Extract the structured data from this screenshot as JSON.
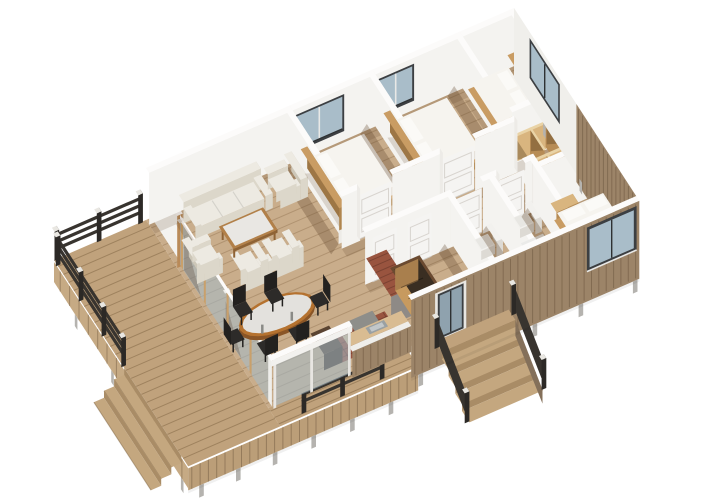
{
  "meta": {
    "title": "3D floor plan rendering",
    "description": "Axonometric 3D floor plan of a single-storey house with wrap-around wooden deck, entry porch and flat-cut white walls",
    "background": "#ffffff"
  },
  "scene": {
    "style": "3d-cutaway-floorplan",
    "rooms": [
      {
        "name": "deck-terrace",
        "floor": "wood planks",
        "features": [
          "dark wood railing",
          "corner steps",
          "side steps",
          "support feet"
        ]
      },
      {
        "name": "living-room",
        "furniture": [
          "three-seat-sofa",
          "armchair",
          "armchair",
          "lounge-chair",
          "lounge-chair",
          "coffee-table-marble-top"
        ]
      },
      {
        "name": "dining-area",
        "furniture": [
          "oval-marble-table-wood-rim",
          "six-black-chairs"
        ],
        "features": [
          "full-height glass wall to deck",
          "glass sliding doors"
        ]
      },
      {
        "name": "kitchen",
        "furniture": [
          "tiled-floor",
          "island-stove",
          "serving-counter-with-sink",
          "dark-cabinet"
        ]
      },
      {
        "name": "entry",
        "features": [
          "glazed-front-door",
          "stair-opening-plywood-lined",
          "masonry-hearth",
          "porch-with-steps-and-railing"
        ]
      },
      {
        "name": "hallway",
        "features": [
          "white-paneled-doors"
        ]
      },
      {
        "name": "bedroom-1",
        "furniture": [
          "double-bed-wood-headboard"
        ],
        "features": [
          "back-wall-window"
        ]
      },
      {
        "name": "bedroom-2",
        "furniture": [
          "double-bed-wood-headboard"
        ],
        "features": [
          "back-wall-window"
        ]
      },
      {
        "name": "bedroom-3",
        "furniture": [
          "double-bed-wood-headboard"
        ],
        "features": [
          "end-wall-window"
        ]
      },
      {
        "name": "walk-in-closet",
        "furniture": [
          "plywood-wardrobe-unit",
          "plywood-wardrobe-unit"
        ]
      },
      {
        "name": "bathroom-1",
        "furniture": [
          "vanity-sink",
          "toilet"
        ]
      },
      {
        "name": "bathroom-2",
        "furniture": [
          "vanity-sink",
          "toilet"
        ]
      },
      {
        "name": "master-bedroom",
        "furniture": [
          "double-bed",
          "wood-bench"
        ],
        "features": [
          "front-wall-window"
        ]
      }
    ]
  },
  "palette": {
    "bg": "#ffffff",
    "floorWood": "#c9ad8b",
    "floorLine": "rgba(136,106,72,0.38)",
    "deckWood": "#c0a27c",
    "deckLine": "rgba(118,90,58,0.45)",
    "deckFascia": "#bb9e78",
    "deckFasciaSide": "#c6aa84",
    "wallFace": "#f4f3f0",
    "wallCap": "#fcfbfa",
    "wallEnd": "#edebe7",
    "wallShadow": "rgba(92,66,40,0.30)",
    "softShadow": "rgba(92,66,40,0.18)",
    "glass": "rgba(164,188,202,0.55)",
    "glassSolid": "#a9bdc9",
    "glassDark": "#8fa2ae",
    "frameDark": "#3c3f42",
    "postWood": "#c9a06b",
    "postCap": "#efeeea",
    "cornerWood": "#b98a58",
    "railDark": "#38342f",
    "railPost": "#2c2926",
    "railCap": "#e9e7e2",
    "siding": "#9c8468",
    "sidingLine": "rgba(92,70,48,0.40)",
    "sidingDark": "#84705a",
    "feet": "#b5b3af",
    "sofaTop": "#edeae2",
    "sofaFront": "#dcd7ca",
    "sofaSide": "#cdc7b8",
    "woodFurn": "#b28049",
    "woodFurnDark": "#8f6335",
    "marbleTop": "#e9e7e3",
    "tableTop": "#e3e1dd",
    "tableRim": "#b5722f",
    "tableRimDark": "#8a5526",
    "chairBlack": "#23211f",
    "chairSeat": "#2d2b29",
    "bedWood": "#c99c63",
    "mattressTop": "#f6f4ef",
    "mattressFront": "#e4dfd7",
    "mattressSide": "#d8d2c7",
    "pillow": "#fbfaf7",
    "plywood": "#d9b57f",
    "plywoodDark": "#b78c55",
    "plywoodShadow": "rgba(80,56,28,0.35)",
    "plywoodCap": "#e9d3a6",
    "brickTile": "#99543f",
    "brickLine": "rgba(70,35,25,0.35)",
    "grayTop": "#8e8e8a",
    "graySide": "#6f6f6b",
    "stoneGray": "#8e8a86",
    "darkCab": "#4e3a2b",
    "stairRim": "#6b4a30",
    "stairInner": "#c79a5f",
    "stairInner2": "#a97f4d",
    "stairPit": "#3a2e22",
    "vanityWood": "#c89a5e",
    "vanityWoodSide": "#ad7f49",
    "fixtureWhite": "#f2f1ee",
    "fixtureShade": "#dddad4",
    "sinkGray": "#9aa0a2",
    "sinkInner": "#c2c7c9",
    "stepWood": "#c4a77f",
    "stepRiser": "#a98c66"
  }
}
